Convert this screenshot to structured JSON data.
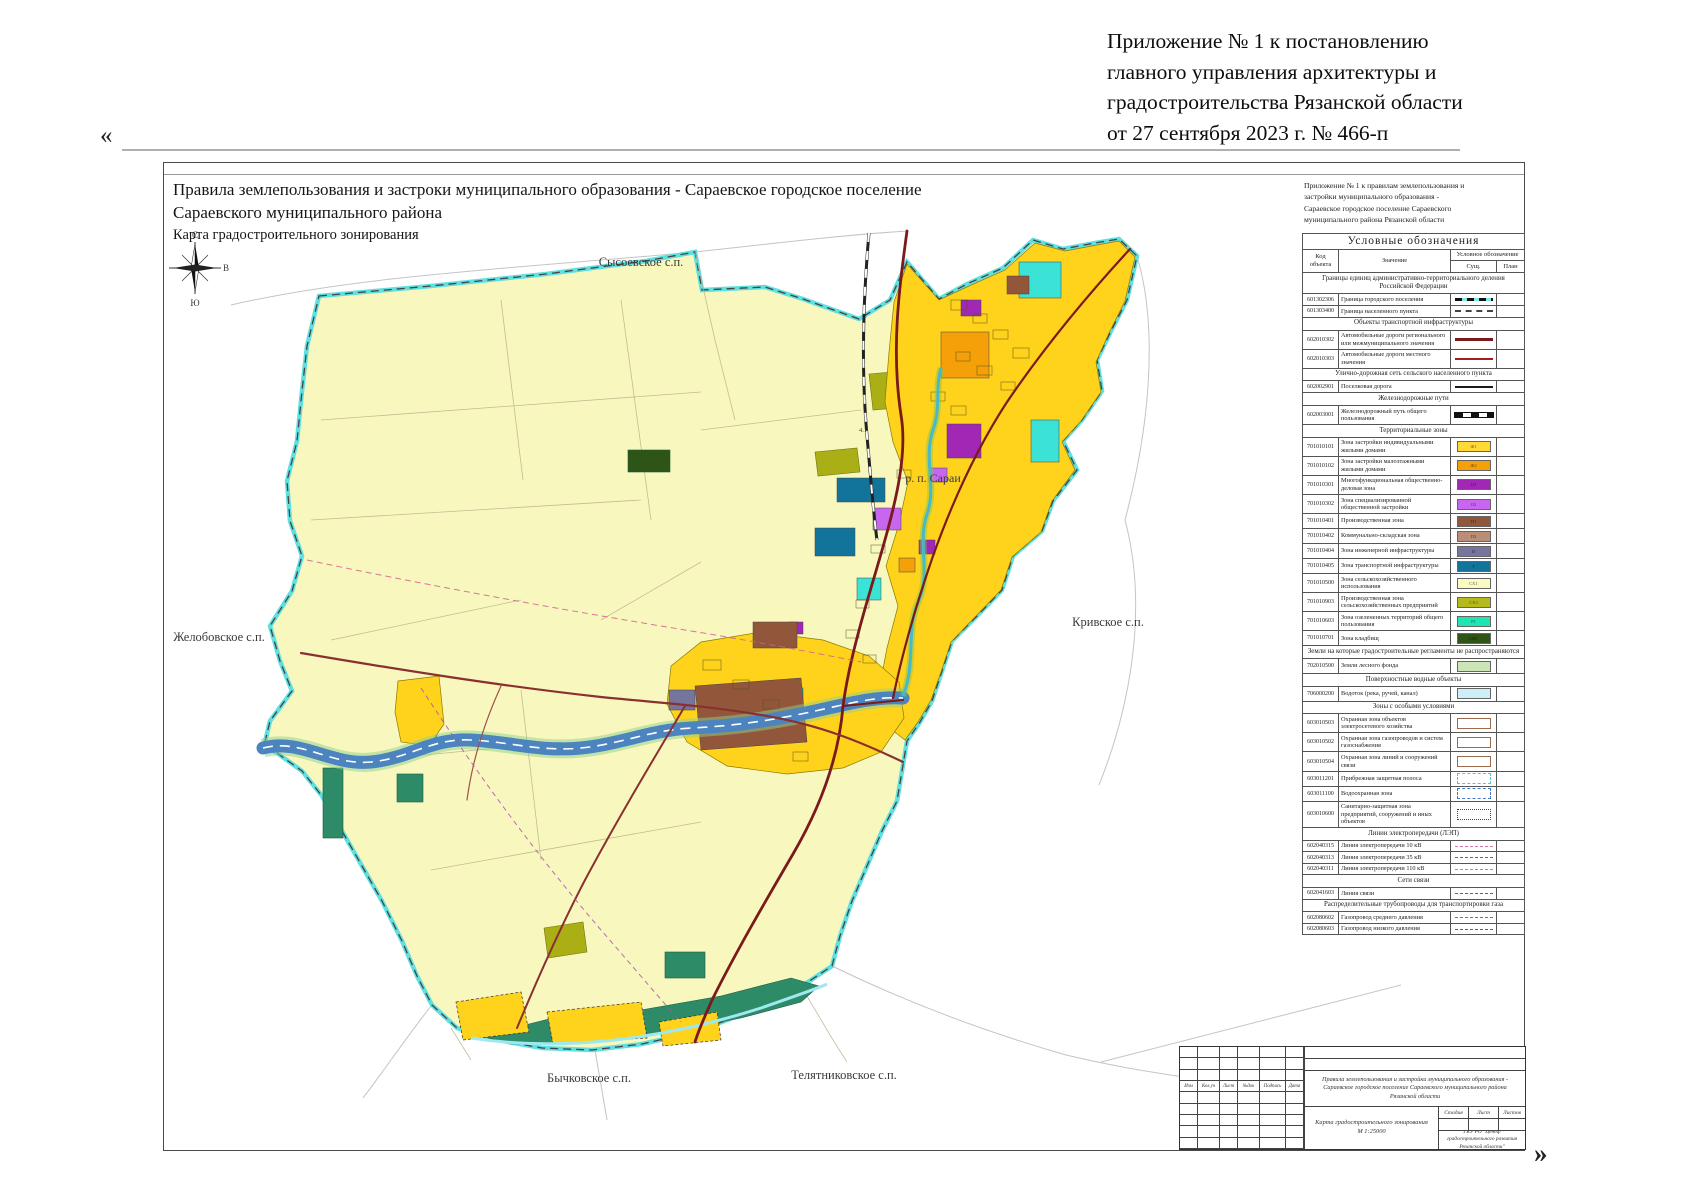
{
  "page": {
    "open_quote": "«",
    "close_quote": "»",
    "header_note": [
      "Приложение № 1 к постановлению",
      "главного управления архитектуры и",
      "градостроительства Рязанской области",
      "от 27 сентября 2023 г. № 466-п"
    ]
  },
  "map_title": {
    "line1": "Правила землепользования и застроки муниципального образования - Сараевское городское поселение",
    "line2": "Сараевского муниципального района",
    "line3": "Карта градостроительного зонирования"
  },
  "map": {
    "labels": {
      "north_settlement": "Сысоевское с.п.",
      "west_settlement": "Желобовское с.п.",
      "east_settlement": "Кривское с.п.",
      "south_settlement1": "Бычковское с.п.",
      "south_settlement2": "Телятниковское с.п.",
      "town": "р. п. Сараи",
      "parcel": "4.1"
    },
    "compass": {
      "n": "С",
      "s": "Ю",
      "w": "З",
      "e": "В"
    }
  },
  "legend": {
    "note": "Приложение № 1 к правилам землепользования и застройки муниципального образования - Сараевское городское поселение Сараевского муниципального района Рязанской области",
    "title": "Условные обозначения",
    "columns": {
      "code": "Код объекта",
      "meaning": "Значение",
      "symbol": "Условное обозначение",
      "sym_exist": "Сущ.",
      "sym_plan": "План"
    },
    "sections": [
      {
        "header": "Границы единиц административно-территориального деления Российской Федерации",
        "rows": [
          {
            "code": "601302306",
            "name": "Граница городского поселения",
            "sym": {
              "type": "line",
              "css": "boundary-city"
            }
          },
          {
            "code": "601303400",
            "name": "Граница населенного пункта",
            "sym": {
              "type": "line",
              "css": "boundary-np"
            }
          }
        ]
      },
      {
        "header": "Объекты транспортной инфраструктуры",
        "rows": [
          {
            "code": "602010302",
            "name": "Автомобильные дороги регионального или межмуниципального значения",
            "sym": {
              "type": "line",
              "css": "road-regional"
            }
          },
          {
            "code": "602010303",
            "name": "Автомобильные дороги местного значения",
            "sym": {
              "type": "line",
              "css": "road-local"
            }
          }
        ]
      },
      {
        "header": "Улично-дорожная сеть сельского населенного пункта",
        "rows": [
          {
            "code": "602002901",
            "name": "Поселковая дорога",
            "sym": {
              "type": "line",
              "css": "road-settlement"
            }
          }
        ]
      },
      {
        "header": "Железнодорожные пути",
        "rows": [
          {
            "code": "602003001",
            "name": "Железнодорожный путь общего пользования",
            "sym": {
              "type": "line",
              "css": "railway"
            }
          }
        ]
      },
      {
        "header": "Территориальные зоны",
        "rows": [
          {
            "code": "701010101",
            "name": "Зона застройки индивидуальными жилыми домами",
            "sym": {
              "type": "zone",
              "color": "#FFD937",
              "label": "Ж1"
            }
          },
          {
            "code": "701010102",
            "name": "Зона застройки малоэтажными жилыми домами",
            "sym": {
              "type": "zone",
              "color": "#F5A009",
              "label": "Ж2"
            }
          },
          {
            "code": "701010301",
            "name": "Многофункциональная общественно-деловая зона",
            "sym": {
              "type": "zone",
              "color": "#A128B5",
              "label": "О1"
            }
          },
          {
            "code": "701010302",
            "name": "Зона специализированной общественной застройки",
            "sym": {
              "type": "zone",
              "color": "#C966F0",
              "label": "О2"
            }
          },
          {
            "code": "701010401",
            "name": "Производственная зона",
            "sym": {
              "type": "zone",
              "color": "#92573A",
              "label": "П1"
            }
          },
          {
            "code": "701010402",
            "name": "Коммунально-складская зона",
            "sym": {
              "type": "zone",
              "color": "#BA8E76",
              "label": "П2"
            }
          },
          {
            "code": "701010404",
            "name": "Зона инженерной инфраструктуры",
            "sym": {
              "type": "zone",
              "color": "#75759E",
              "label": "И"
            }
          },
          {
            "code": "701010405",
            "name": "Зона транспортной инфраструктуры",
            "sym": {
              "type": "zone",
              "color": "#13749B",
              "label": "Т"
            }
          },
          {
            "code": "701010500",
            "name": "Зона сельскохозяйственного использования",
            "sym": {
              "type": "zone",
              "color": "#FBFAC0",
              "label": "СХ1"
            }
          },
          {
            "code": "701010903",
            "name": "Производственная зона сельскохозяйственных предприятий",
            "sym": {
              "type": "zone",
              "color": "#B5BA1C",
              "label": "СХ3"
            }
          },
          {
            "code": "701010603",
            "name": "Зона озелененных территорий общего пользования",
            "sym": {
              "type": "zone",
              "color": "#1FE5B2",
              "label": "Р1"
            }
          },
          {
            "code": "701010701",
            "name": "Зона кладбищ",
            "sym": {
              "type": "zone",
              "color": "#2E5417",
              "label": "СН1"
            }
          }
        ]
      },
      {
        "header": "Земли на которые градостроительные регламенты не распространяются",
        "rows": [
          {
            "code": "702010500",
            "name": "Земли лесного фонда",
            "sym": {
              "type": "zone",
              "color": "#CBE5B6",
              "label": ""
            }
          }
        ]
      },
      {
        "header": "Поверхностные водные объекты",
        "rows": [
          {
            "code": "706000200",
            "name": "Водоток (река, ручей, канал)",
            "sym": {
              "type": "zone",
              "color": "#CDEFF8",
              "label": ""
            }
          }
        ]
      },
      {
        "header": "Зоны с особыми условиями",
        "rows": [
          {
            "code": "603010503",
            "name": "Охранная зона объектов электросетевого хозяйства",
            "sym": {
              "type": "box",
              "css": "box-plain"
            }
          },
          {
            "code": "603010502",
            "name": "Охранная зона газопроводов и систем газоснабжения",
            "sym": {
              "type": "box",
              "css": "box-plain"
            }
          },
          {
            "code": "603010504",
            "name": "Охранная зона линий и сооружений связи",
            "sym": {
              "type": "box",
              "css": "box-plain"
            }
          },
          {
            "code": "603011201",
            "name": "Прибрежная защитная полоса",
            "sym": {
              "type": "box",
              "css": "box-cyan"
            }
          },
          {
            "code": "603011100",
            "name": "Водоохранная зона",
            "sym": {
              "type": "box",
              "css": "box-blue"
            }
          },
          {
            "code": "603010600",
            "name": "Санитарно-защитная зона предприятий, сооружений и иных объектов",
            "sym": {
              "type": "box",
              "css": "box-dotted"
            }
          }
        ]
      },
      {
        "header": "Линии электропередачи (ЛЭП)",
        "rows": [
          {
            "code": "602040315",
            "name": "Линия электропередачи 10 кВ",
            "sym": {
              "type": "line",
              "css": "lep10"
            }
          },
          {
            "code": "602040313",
            "name": "Линия электропередачи 35 кВ",
            "sym": {
              "type": "line",
              "css": "lep35"
            }
          },
          {
            "code": "602040311",
            "name": "Линия электропередачи 110 кВ",
            "sym": {
              "type": "line",
              "css": "lep110"
            }
          }
        ]
      },
      {
        "header": "Сети связи",
        "rows": [
          {
            "code": "602041603",
            "name": "Линия связи",
            "sym": {
              "type": "line",
              "css": "comm-line"
            }
          }
        ]
      },
      {
        "header": "Распределительные трубопроводы для транспортировки газа",
        "rows": [
          {
            "code": "602080602",
            "name": "Газопровод среднего давления",
            "sym": {
              "type": "line",
              "css": "gas-mid"
            }
          },
          {
            "code": "602080603",
            "name": "Газопровод низкого давления",
            "sym": {
              "type": "line",
              "css": "gas-low"
            }
          }
        ]
      }
    ]
  },
  "stamp": {
    "cols": [
      "Изм",
      "Кол.уч",
      "Лист",
      "№док",
      "Подпись",
      "Дата"
    ],
    "project": "Правила землепользования и застройки муниципального образования - Сараевское городское поселение Сараевского муниципального района Рязанской области",
    "stage": "Стадия",
    "sheet": "Лист",
    "sheets": "Листов",
    "doc_name": "Карта градостроительного зонирования",
    "doc_scale": "М 1:25000",
    "org": "ГКУ РО \"Центр градостроительного развития Рязанской области\""
  }
}
